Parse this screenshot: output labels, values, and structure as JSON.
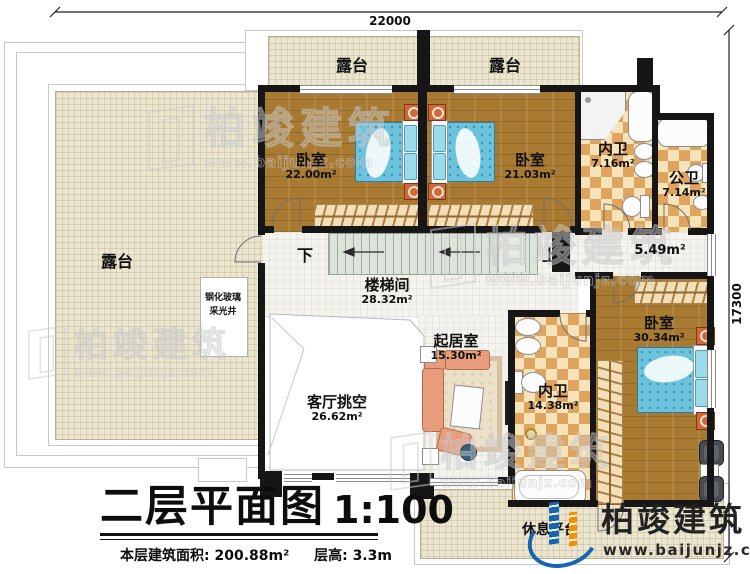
{
  "title": {
    "main": "二层平面图",
    "scale": "1:100",
    "area_note": "本层建筑面积: 200.88m²",
    "height_note": "层高: 3.3m"
  },
  "dimensions": {
    "width": "22000",
    "height": "17300"
  },
  "rooms": {
    "terrace_left": {
      "label": "露台"
    },
    "terrace_top_left": {
      "label": "露台"
    },
    "terrace_top_right": {
      "label": "露台"
    },
    "bedroom_top_left": {
      "label": "卧室",
      "area": "22.00m²"
    },
    "bedroom_top_right": {
      "label": "卧室",
      "area": "21.03m²"
    },
    "bath_ensuite_top": {
      "label": "内卫",
      "area": "7.16m²"
    },
    "bath_shared": {
      "label": "公卫",
      "area": "7.14m²"
    },
    "stairwell": {
      "label": "楼梯间",
      "area": "28.32m²"
    },
    "landing": {
      "area": "5.49m²"
    },
    "living_void": {
      "label": "客厅挑空",
      "area": "26.62m²"
    },
    "sitting_room": {
      "label": "起居室",
      "area": "15.30m²"
    },
    "bath_ensuite_master": {
      "label": "内卫",
      "area": "14.38m²"
    },
    "bedroom_master": {
      "label": "卧室",
      "area": "30.34m²"
    },
    "rest_platform": {
      "label": "休息平台"
    },
    "lightwell": {
      "line1": "钢化玻璃",
      "line2": "采光井"
    }
  },
  "stairs": {
    "down": "下",
    "up": "上"
  },
  "branding": {
    "name": "柏竣建筑",
    "url": "www.baijunjz.com"
  },
  "watermark": {
    "text": "柏竣建筑",
    "url": "www.baijunjz.com"
  },
  "colors": {
    "wall": "#161616",
    "wood_floor": "#a97a31",
    "terrace": "#ece6d1",
    "checker_dark": "#dfa55e",
    "checker_light": "#f6e3ba",
    "bed": "#6cc3de",
    "logo_blue": "#1565af",
    "logo_orange": "#f29200",
    "logo_text": "#222222"
  }
}
